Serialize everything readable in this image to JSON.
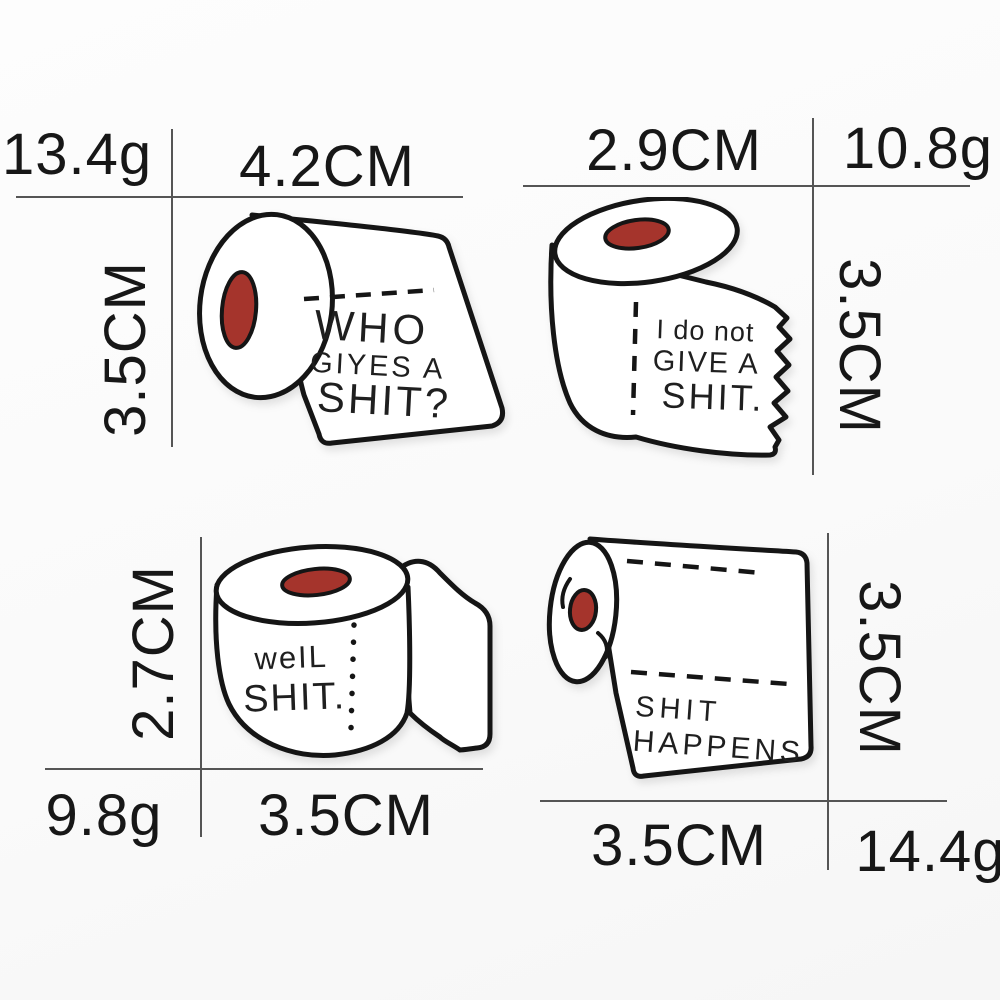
{
  "image_type": "product dimension diagram of four toilet-paper-roll enamel pins",
  "colors": {
    "background": "#fafafa",
    "dimension_line": "#555555",
    "label_text": "#171717",
    "pin_outline": "#151515",
    "pin_fill": "#ffffff",
    "core_red": "#a5342c"
  },
  "pins": [
    {
      "name": "who-gives-a-shit",
      "description": "horizontal roll, end facing left, sheet draped to the right",
      "lines": [
        "WHO",
        "GIYES A",
        "SHIT?"
      ],
      "width_label": "4.2CM",
      "height_label": "3.5CM",
      "weight_label": "13.4g"
    },
    {
      "name": "i-do-not-give-a-shit",
      "description": "upright roll, sheet with torn zigzag edge draped right",
      "lines": [
        "I do not",
        "GIVE A",
        "SHIT."
      ],
      "width_label": "2.9CM",
      "height_label": "3.5CM",
      "weight_label": "10.8g"
    },
    {
      "name": "well-shit",
      "description": "upright roll with folded flap on the right",
      "lines": [
        "weIL",
        "SHIT."
      ],
      "width_label": "3.5CM",
      "height_label": "2.7CM",
      "weight_label": "9.8g"
    },
    {
      "name": "shit-happens",
      "description": "horizontal roll, end facing left, wide sheet with two perforation lines",
      "lines": [
        "SHIT",
        "HAPPENS"
      ],
      "width_label": "3.5CM",
      "height_label": "3.5CM",
      "weight_label": "14.4g"
    }
  ]
}
